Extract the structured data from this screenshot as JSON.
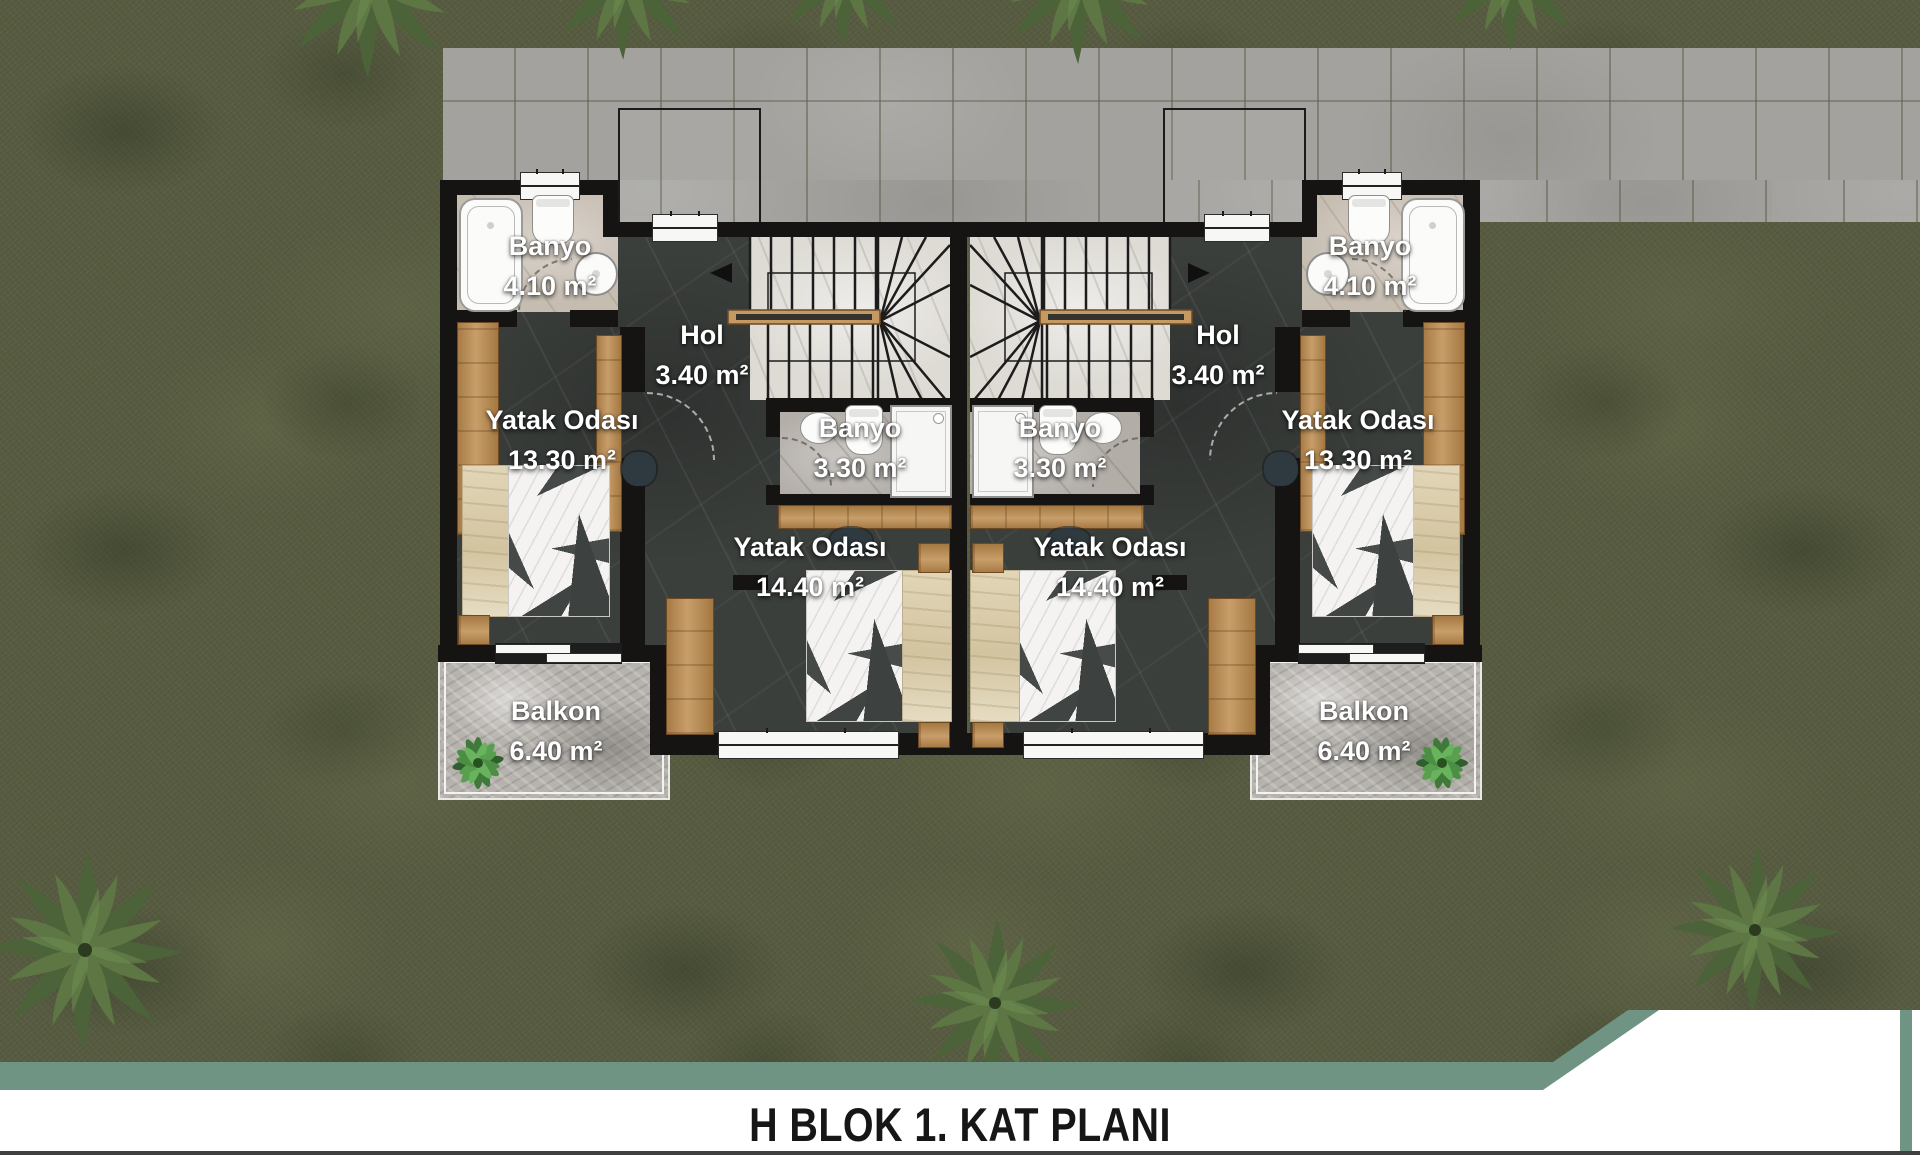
{
  "title": "H BLOK 1. KAT PLANI",
  "rooms": {
    "banyo_4_10": {
      "name": "Banyo",
      "area": "4.10 m²"
    },
    "hol": {
      "name": "Hol",
      "area": "3.40 m²"
    },
    "banyo_3_30": {
      "name": "Banyo",
      "area": "3.30 m²"
    },
    "yatak_13_30": {
      "name": "Yatak Odası",
      "area": "13.30 m²"
    },
    "yatak_14_40": {
      "name": "Yatak Odası",
      "area": "14.40 m²"
    },
    "balkon": {
      "name": "Balkon",
      "area": "6.40 m²"
    }
  },
  "colors": {
    "accent_teal": "#6f9484",
    "grass": "#575c41",
    "pavement": "#a3a29e",
    "wall_black": "#151412",
    "floor_dark_marble": "#3b3f3c",
    "wood": "#c79e69",
    "label_text": "#ffffff",
    "title_text": "#161616"
  }
}
